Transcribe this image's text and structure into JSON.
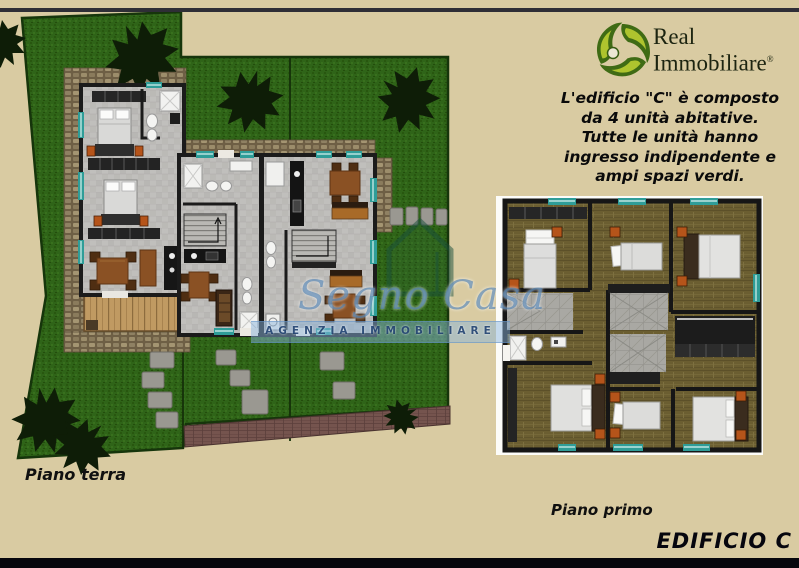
{
  "page": {
    "background_color": "#d9cba2"
  },
  "branding": {
    "agency_line1": "Real",
    "agency_line2": "Immobiliare",
    "trademark": "®",
    "logo_dark_green": "#3f6b14",
    "logo_light_green": "#aec42e"
  },
  "description": {
    "text": "L'edificio \"C\" è composto\nda 4 unità abitative.\nTutte le unità hanno\ningresso indipendente e\nampi spazi verdi."
  },
  "labels": {
    "ground_floor": "Piano terra",
    "first_floor": "Piano primo",
    "building_name": "EDIFICIO C"
  },
  "watermark": {
    "agency_name": "Segno Casa",
    "agency_subtitle": "AGENZIA IMMOBILIARE",
    "color": "#4e7cab"
  },
  "palette": {
    "lawn_green": "#2f6418",
    "cobblestone": "#9c8d6b",
    "building_floor_gray": "#c0bfbc",
    "wood_floor": "#6b5e31",
    "wall_black": "#1b1b1b",
    "window_teal": "#2f9d98",
    "deck_wood": "#c09a62",
    "driveway_brown": "#75544e"
  }
}
